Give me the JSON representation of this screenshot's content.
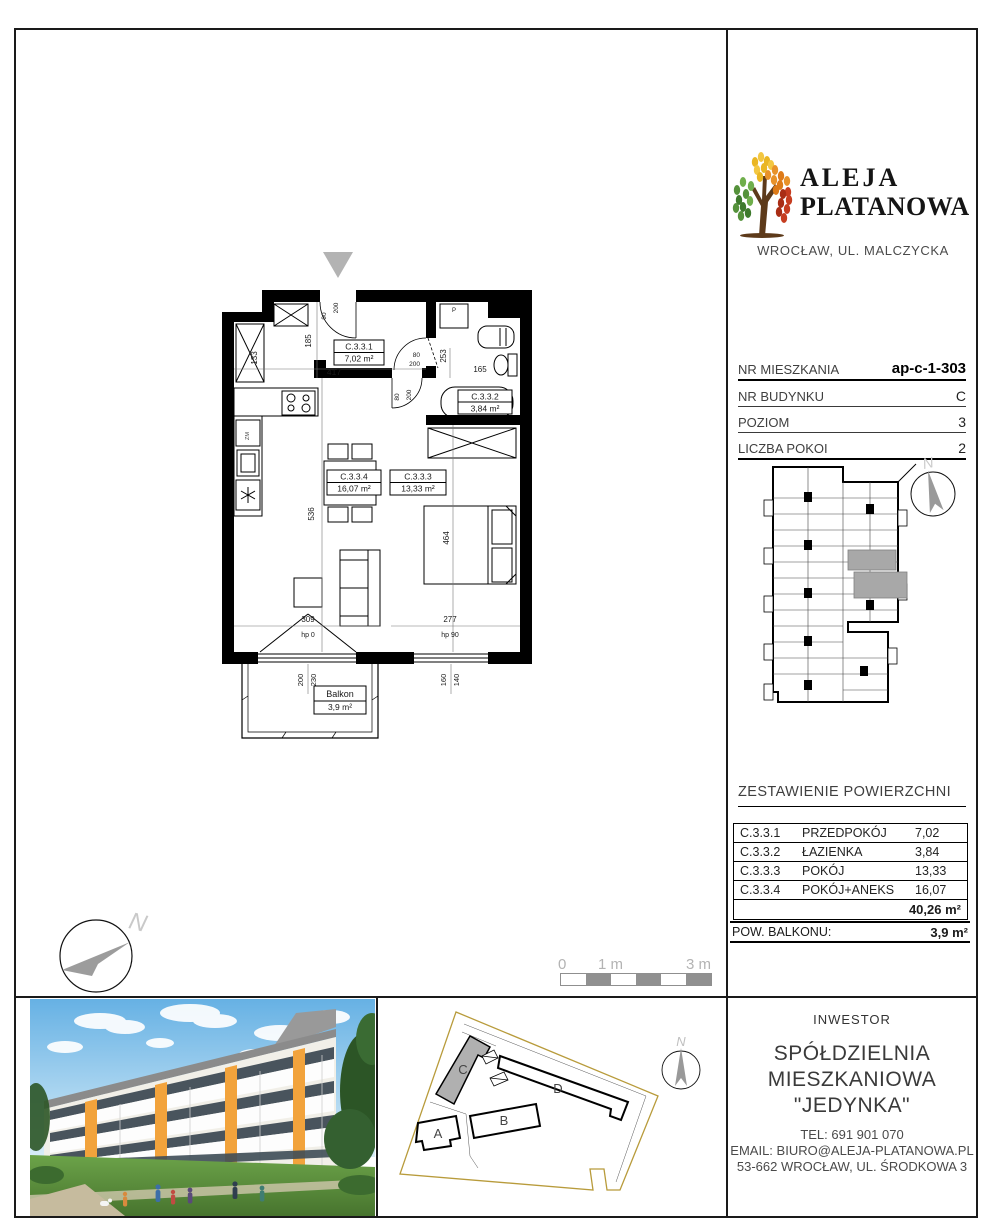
{
  "brand": {
    "name1": "ALEJA",
    "name2": "PLATANOWA",
    "location": "WROCŁAW, UL. MALCZYCKA"
  },
  "info": {
    "rows": [
      {
        "label": "NR MIESZKANIA",
        "value": "ap-c-1-303"
      },
      {
        "label": "NR BUDYNKU",
        "value": "C"
      },
      {
        "label": "POZIOM",
        "value": "3"
      },
      {
        "label": "LICZBA POKOI",
        "value": "2"
      }
    ]
  },
  "minimap": {
    "north": "N"
  },
  "areas": {
    "title": "ZESTAWIENIE POWIERZCHNI",
    "rows": [
      {
        "code": "C.3.3.1",
        "name": "PRZEDPOKÓJ",
        "value": "7,02"
      },
      {
        "code": "C.3.3.2",
        "name": "ŁAZIENKA",
        "value": "3,84"
      },
      {
        "code": "C.3.3.3",
        "name": "POKÓJ",
        "value": "13,33"
      },
      {
        "code": "C.3.3.4",
        "name": "POKÓJ+ANEKS",
        "value": "16,07"
      }
    ],
    "total": "40,26 m²",
    "balcony_label": "POW. BALKONU:",
    "balcony_value": "3,9 m²"
  },
  "plan": {
    "rooms": {
      "hall": {
        "code": "C.3.3.1",
        "area": "7,02 m²"
      },
      "bath": {
        "code": "C.3.3.2",
        "area": "3,84 m²"
      },
      "bed": {
        "code": "C.3.3.3",
        "area": "13,33 m²"
      },
      "living": {
        "code": "C.3.3.4",
        "area": "16,07 m²"
      }
    },
    "balcony": {
      "name": "Balkon",
      "area": "3,9 m²"
    },
    "dims": {
      "hall_width": "417",
      "hall_offset": "185",
      "shaft": "133",
      "bath_width": "165",
      "bath_depth": "253",
      "living_depth": "536",
      "bed_depth": "464",
      "living_width": "309",
      "bed_width": "277",
      "sill_left": "hp 0",
      "sill_right": "hp 90",
      "win_left_a": "200",
      "win_left_b": "230",
      "win_right_a": "160",
      "win_right_b": "140"
    },
    "doors": {
      "entrance_w": "90",
      "entrance_h": "200",
      "bath_w": "80",
      "bath_h": "200",
      "bed_w": "80",
      "bed_h": "200"
    },
    "appliances": {
      "washer": "P",
      "dishwasher": "ZM"
    },
    "compass_north": "N"
  },
  "scalebar": {
    "l0": "0",
    "l1": "1 m",
    "l3": "3 m"
  },
  "siteplan": {
    "a": "A",
    "b": "B",
    "c": "C",
    "d": "D",
    "north": "N"
  },
  "investor": {
    "heading": "INWESTOR",
    "name1": "SPÓŁDZIELNIA",
    "name2": "MIESZKANIOWA \"JEDYNKA\"",
    "tel": "TEL: 691 901 070",
    "email": "EMAIL: BIURO@ALEJA-PLATANOWA.PL",
    "address": "53-662 WROCŁAW, UL. ŚRODKOWA 3"
  }
}
